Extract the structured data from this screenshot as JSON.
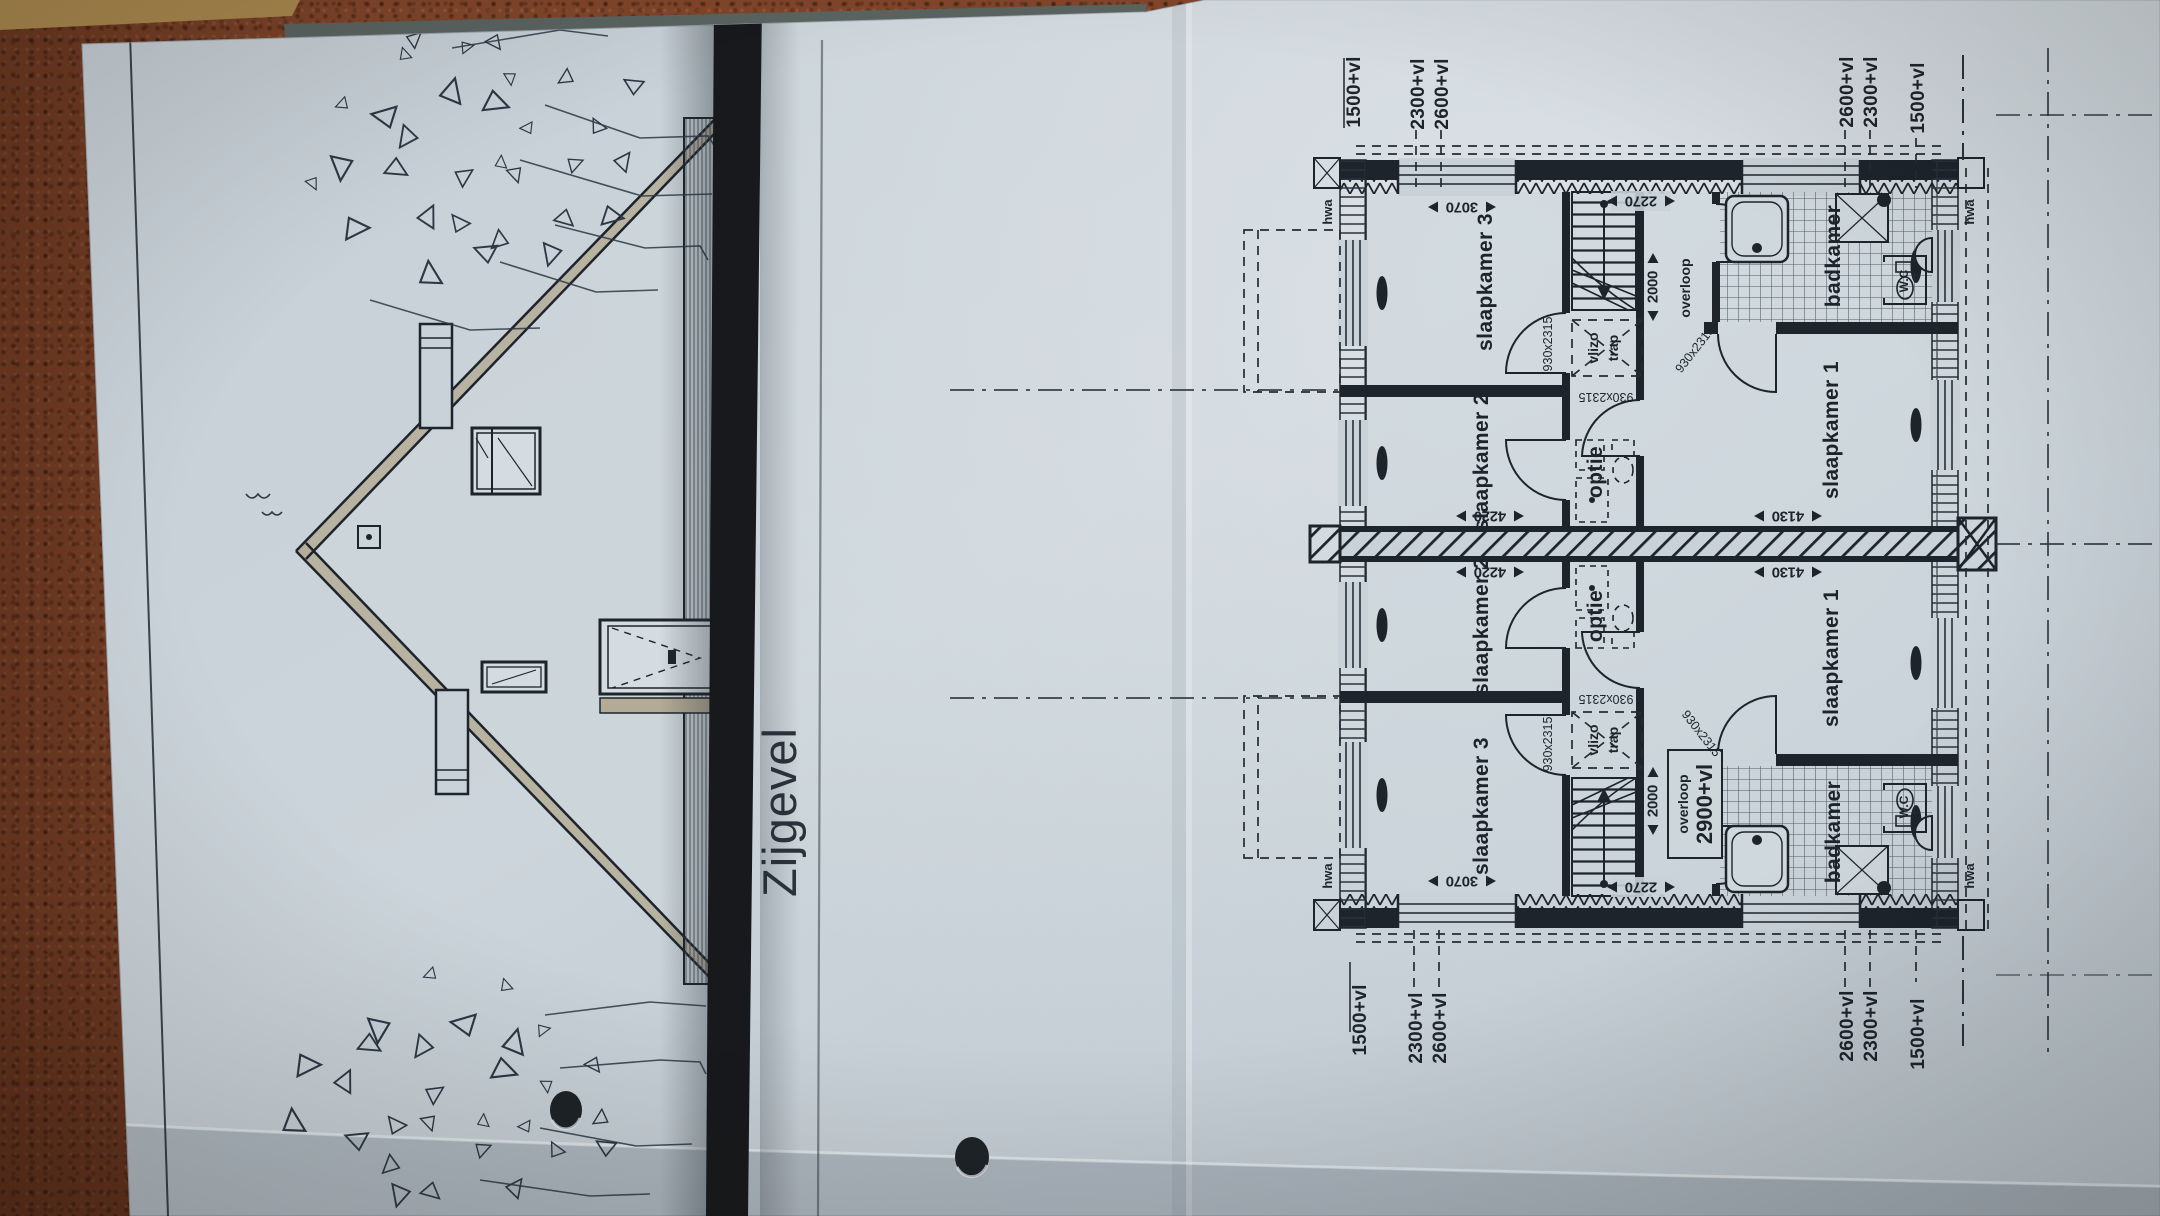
{
  "colors": {
    "leather": "#82462a",
    "paper": "#c9d2d8",
    "ink": "#1d242c",
    "fold_strip": "#17191c",
    "wood_edge": "#a9884e",
    "shadow_band": "#5a6460",
    "fixture_fill": "#cfd8dd",
    "eaves_fill": "#b4ab96"
  },
  "elevation": {
    "title": "Zijgevel"
  },
  "plan": {
    "rooms": {
      "slaapkamer1": "slaapkamer 1",
      "slaapkamer2": "slaapkamer 2",
      "slaapkamer3": "slaapkamer 3",
      "badkamer": "badkamer",
      "overloop": "overloop",
      "overloop_level": "2900+vl",
      "optie": "optie",
      "vlizotrap_line1": "vlizo",
      "vlizotrap_line2": "trap",
      "wc": "W.C"
    },
    "dims": {
      "d3070": "3070",
      "d2270": "2270",
      "d4130": "4130",
      "d4220": "4220",
      "d2000": "2000",
      "door": "930x2315"
    },
    "levels": {
      "v1500": "1500+vl",
      "v2300": "2300+vl",
      "v2600": "2600+vl"
    },
    "drain": "hwa"
  }
}
